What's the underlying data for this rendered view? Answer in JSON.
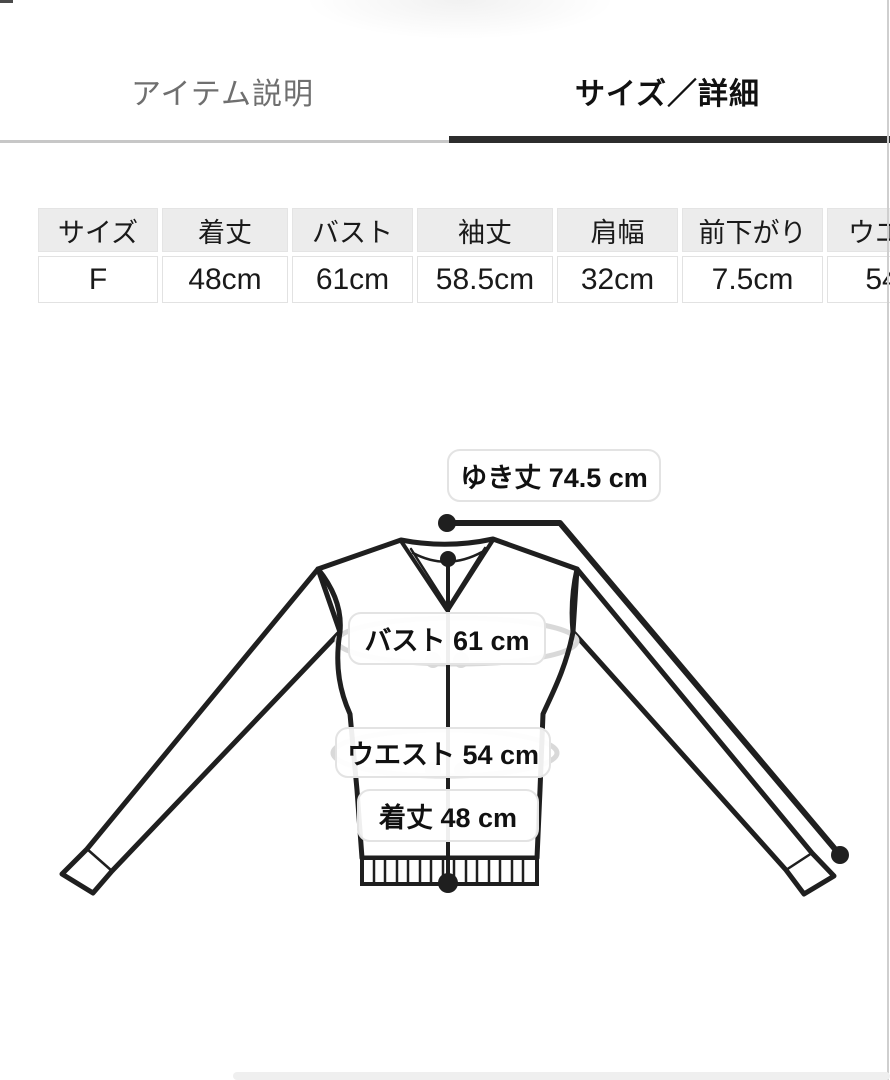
{
  "tabs": [
    {
      "label": "アイテム説明",
      "active": false
    },
    {
      "label": "サイズ／詳細",
      "active": true
    }
  ],
  "size_table": {
    "headers": [
      "サイズ",
      "着丈",
      "バスト",
      "袖丈",
      "肩幅",
      "前下がり",
      "ウエスト"
    ],
    "row": [
      "F",
      "48cm",
      "61cm",
      "58.5cm",
      "32cm",
      "7.5cm",
      "54cm"
    ]
  },
  "diagram": {
    "sleeve_length_label": "ゆき丈 74.5 cm",
    "bust_label": "バスト 61 cm",
    "waist_label": "ウエスト 54 cm",
    "length_label": "着丈 48 cm"
  },
  "colors": {
    "active_tab_underline": "#2d2d2d",
    "inactive_tab_text": "#6f6f6f",
    "table_header_bg": "#ececec",
    "garment_line": "#1f1f1f",
    "tape_ellipse": "#d9d9d9"
  }
}
